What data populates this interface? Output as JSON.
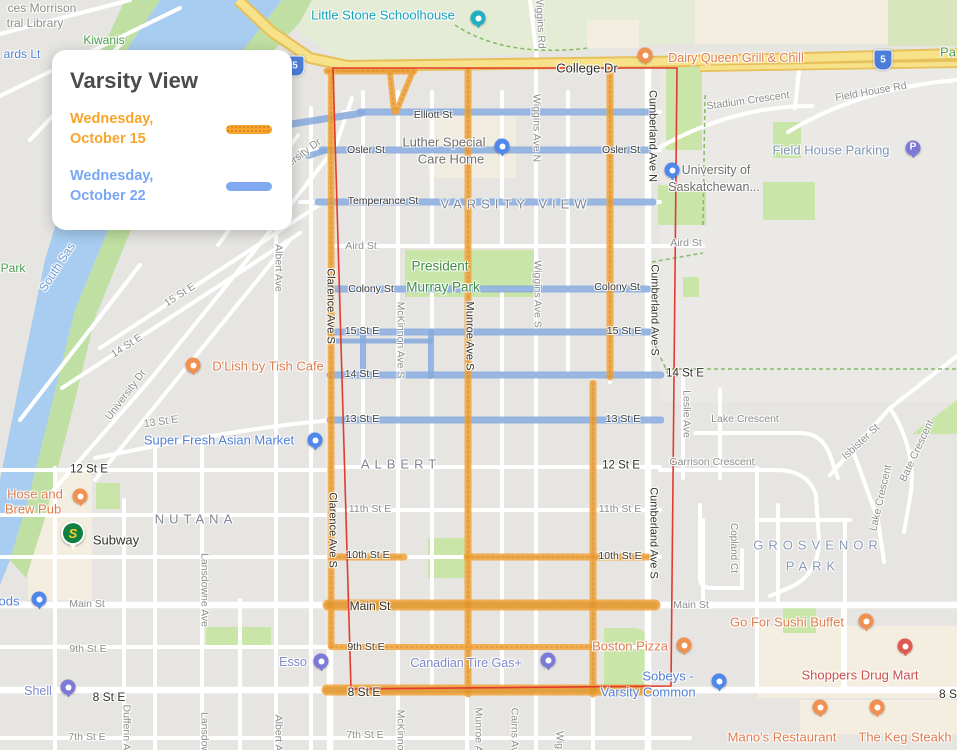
{
  "legend": {
    "title": "Varsity View",
    "entries": [
      {
        "day": "Wednesday,",
        "date": "October 15",
        "color": "#f9a42c",
        "text_color": "#f9a42c"
      },
      {
        "day": "Wednesday,",
        "date": "October 22",
        "color": "#80a9f0",
        "text_color": "#79a7f2"
      }
    ]
  },
  "map": {
    "neighborhood": "Varsity View",
    "boundary": {
      "color": "#e23a2e",
      "points": "333,68 677,68 671,686 351,689"
    },
    "routes": {
      "oct15": {
        "label": "Wednesday, October 15",
        "color": "#f1a33b",
        "texture": "#cf861b",
        "segments": [
          [
            331,
            72,
            331,
            645,
            7
          ],
          [
            468,
            71,
            468,
            694,
            7
          ],
          [
            610,
            71,
            610,
            377,
            7
          ],
          [
            593,
            383,
            593,
            694,
            7
          ],
          [
            327,
            71,
            414,
            71,
            7
          ],
          [
            390,
            73,
            394,
            111,
            6
          ],
          [
            413,
            71,
            396,
            112,
            6
          ],
          [
            334,
            557,
            404,
            557,
            7
          ],
          [
            467,
            557,
            648,
            557,
            7
          ],
          [
            328,
            605,
            655,
            605,
            11
          ],
          [
            331,
            647,
            599,
            647,
            6
          ],
          [
            327,
            690,
            647,
            690,
            11
          ]
        ]
      },
      "oct22": {
        "label": "Wednesday, October 22",
        "color": "#86aadd",
        "segments": [
          [
            273,
            127,
            362,
            113,
            7
          ],
          [
            360,
            112,
            650,
            112,
            7
          ],
          [
            308,
            156,
            324,
            151,
            6
          ],
          [
            322,
            150,
            648,
            150,
            7
          ],
          [
            318,
            202,
            653,
            202,
            7
          ],
          [
            330,
            289,
            648,
            289,
            7
          ],
          [
            330,
            332,
            651,
            332,
            7
          ],
          [
            333,
            341,
            431,
            341,
            5
          ],
          [
            330,
            375,
            661,
            375,
            7
          ],
          [
            330,
            420,
            661,
            420,
            7
          ],
          [
            363,
            332,
            363,
            376,
            6
          ],
          [
            431,
            332,
            431,
            376,
            6
          ]
        ]
      }
    },
    "highway_shields": [
      {
        "n": "5",
        "x": 295,
        "y": 66
      },
      {
        "n": "5",
        "x": 883,
        "y": 60
      }
    ],
    "labels": [
      {
        "t": "ces Morrison",
        "x": 42,
        "y": 8,
        "c": "g",
        "fs": 12
      },
      {
        "t": "tral Library",
        "x": 35,
        "y": 23,
        "c": "g",
        "fs": 12
      },
      {
        "t": "ards Lt",
        "x": 22,
        "y": 54,
        "c": "bl",
        "fs": 12
      },
      {
        "t": "Kiwanis",
        "x": 104,
        "y": 40,
        "c": "grn"
      },
      {
        "t": "Little Stone Schoolhouse",
        "x": 383,
        "y": 15,
        "c": "teal"
      },
      {
        "t": "Wiggins Rd",
        "x": 540,
        "y": 22,
        "r": 87,
        "c": "gv"
      },
      {
        "t": "College Dr",
        "x": 587,
        "y": 68,
        "c": "db",
        "fs": 13
      },
      {
        "t": "Dairy Queen Grill & Chill",
        "x": 736,
        "y": 58,
        "c": "o"
      },
      {
        "t": "Pa",
        "x": 948,
        "y": 52,
        "c": "grn",
        "fs": 13
      },
      {
        "t": "Stadium Crescent",
        "x": 748,
        "y": 101,
        "r": -8,
        "c": "g"
      },
      {
        "t": "Field House Rd",
        "x": 871,
        "y": 92,
        "r": -10,
        "c": "g"
      },
      {
        "t": "Field House Parking",
        "x": 831,
        "y": 150,
        "c": "fhp"
      },
      {
        "t": "University of",
        "x": 716,
        "y": 170,
        "c": "u"
      },
      {
        "t": "Saskatchewan...",
        "x": 714,
        "y": 187,
        "c": "u"
      },
      {
        "t": "Cumberland Ave N",
        "x": 652,
        "y": 136,
        "r": 90,
        "c": "dv"
      },
      {
        "t": "Elliott St",
        "x": 433,
        "y": 115,
        "c": "d"
      },
      {
        "t": "Osler St",
        "x": 366,
        "y": 150,
        "c": "d"
      },
      {
        "t": "Osler St",
        "x": 621,
        "y": 150,
        "c": "d"
      },
      {
        "t": "Luther Special",
        "x": 444,
        "y": 142,
        "c": "u",
        "fs": 13
      },
      {
        "t": "Care Home",
        "x": 451,
        "y": 159,
        "c": "u",
        "fs": 13
      },
      {
        "t": "Temperance St",
        "x": 383,
        "y": 201,
        "c": "d"
      },
      {
        "t": "VARSITY VIEW",
        "x": 516,
        "y": 204,
        "c": "hood"
      },
      {
        "t": "17 St E",
        "x": 261,
        "y": 186,
        "r": -52,
        "c": "g"
      },
      {
        "t": "University Dr",
        "x": 296,
        "y": 159,
        "r": -37,
        "c": "g"
      },
      {
        "t": "Aird St",
        "x": 361,
        "y": 246,
        "c": "g"
      },
      {
        "t": "Aird St",
        "x": 686,
        "y": 243,
        "c": "g"
      },
      {
        "t": "Albert Ave",
        "x": 278,
        "y": 268,
        "r": 90,
        "c": "gv"
      },
      {
        "t": "South Sas",
        "x": 57,
        "y": 267,
        "r": -57,
        "c": "wat"
      },
      {
        "t": "Park",
        "x": 13,
        "y": 268,
        "c": "grn"
      },
      {
        "t": "President",
        "x": 440,
        "y": 266,
        "c": "pk"
      },
      {
        "t": "Murray Park",
        "x": 443,
        "y": 287,
        "c": "pk"
      },
      {
        "t": "Colony St",
        "x": 371,
        "y": 289,
        "c": "d"
      },
      {
        "t": "Colony St",
        "x": 617,
        "y": 287,
        "c": "d"
      },
      {
        "t": "Clarence Ave S",
        "x": 330,
        "y": 306,
        "r": 90,
        "c": "dv"
      },
      {
        "t": "Clarence Ave S",
        "x": 332,
        "y": 530,
        "r": 90,
        "c": "dv"
      },
      {
        "t": "McKinnon Ave S",
        "x": 400,
        "y": 340,
        "r": 90,
        "c": "gv"
      },
      {
        "t": "Munroe Ave S",
        "x": 469,
        "y": 336,
        "r": 90,
        "c": "dv"
      },
      {
        "t": "Wiggins Ave N",
        "x": 536,
        "y": 128,
        "r": 90,
        "c": "gv"
      },
      {
        "t": "Wiggins Ave S",
        "x": 537,
        "y": 294,
        "r": 90,
        "c": "gv"
      },
      {
        "t": "Cumberland Ave S",
        "x": 654,
        "y": 310,
        "r": 90,
        "c": "dv"
      },
      {
        "t": "Cumberland Ave S",
        "x": 653,
        "y": 533,
        "r": 90,
        "c": "dv"
      },
      {
        "t": "15 St E",
        "x": 362,
        "y": 331,
        "c": "d"
      },
      {
        "t": "15 St E",
        "x": 624,
        "y": 331,
        "c": "d"
      },
      {
        "t": "15 St E",
        "x": 180,
        "y": 295,
        "r": -33,
        "c": "g"
      },
      {
        "t": "14 St E",
        "x": 362,
        "y": 374,
        "c": "d"
      },
      {
        "t": "14 St E",
        "x": 685,
        "y": 374,
        "c": "db",
        "fs": 11.5
      },
      {
        "t": "14 St E",
        "x": 127,
        "y": 346,
        "r": -33,
        "c": "g"
      },
      {
        "t": "University Dr",
        "x": 126,
        "y": 395,
        "r": -53,
        "c": "g"
      },
      {
        "t": "13 St E",
        "x": 362,
        "y": 419,
        "c": "d"
      },
      {
        "t": "13 St E",
        "x": 623,
        "y": 419,
        "c": "d"
      },
      {
        "t": "13 St E",
        "x": 161,
        "y": 422,
        "r": -8,
        "c": "g"
      },
      {
        "t": "D'Lish by Tish Cafe",
        "x": 268,
        "y": 366,
        "c": "o",
        "fs": 13
      },
      {
        "t": "Super Fresh Asian Market",
        "x": 219,
        "y": 440,
        "c": "bl",
        "fs": 13
      },
      {
        "t": "12 St E",
        "x": 89,
        "y": 470,
        "c": "db",
        "fs": 11.5
      },
      {
        "t": "12 St E",
        "x": 621,
        "y": 466,
        "c": "db",
        "fs": 11.5
      },
      {
        "t": "ALBERT",
        "x": 401,
        "y": 464,
        "c": "hood"
      },
      {
        "t": "Lake Crescent",
        "x": 745,
        "y": 419,
        "c": "g"
      },
      {
        "t": "Garrison Crescent",
        "x": 712,
        "y": 462,
        "c": "g"
      },
      {
        "t": "Leslie Ave",
        "x": 686,
        "y": 414,
        "r": 90,
        "c": "gv"
      },
      {
        "t": "Isbister St",
        "x": 861,
        "y": 442,
        "r": -43,
        "c": "g"
      },
      {
        "t": "Bate Crescent",
        "x": 917,
        "y": 451,
        "r": -65,
        "c": "g"
      },
      {
        "t": "Lake Crescent",
        "x": 881,
        "y": 498,
        "r": -77,
        "c": "g"
      },
      {
        "t": "11th St E",
        "x": 370,
        "y": 509,
        "c": "g"
      },
      {
        "t": "11th St E",
        "x": 620,
        "y": 509,
        "c": "g"
      },
      {
        "t": "10th St E",
        "x": 368,
        "y": 555,
        "c": "d"
      },
      {
        "t": "10th St E",
        "x": 620,
        "y": 556,
        "c": "d"
      },
      {
        "t": "NUTANA",
        "x": 196,
        "y": 519,
        "c": "hood"
      },
      {
        "t": "Hose and",
        "x": 35,
        "y": 494,
        "c": "o",
        "fs": 13
      },
      {
        "t": "Brew Pub",
        "x": 33,
        "y": 509,
        "c": "o",
        "fs": 13
      },
      {
        "t": "ods",
        "x": 9,
        "y": 601,
        "c": "bl",
        "fs": 13
      },
      {
        "t": "Subway",
        "x": 116,
        "y": 540,
        "c": "db",
        "fs": 13
      },
      {
        "t": "Lansdowne Ave",
        "x": 204,
        "y": 590,
        "r": 90,
        "c": "gv"
      },
      {
        "t": "GROSVENOR",
        "x": 818,
        "y": 545,
        "c": "hoodb"
      },
      {
        "t": "PARK",
        "x": 813,
        "y": 566,
        "c": "hoodb"
      },
      {
        "t": "Copland Ct",
        "x": 733,
        "y": 548,
        "r": 90,
        "c": "gv",
        "fs": 10
      },
      {
        "t": "Main St",
        "x": 87,
        "y": 604,
        "c": "g"
      },
      {
        "t": "Main St",
        "x": 370,
        "y": 606,
        "c": "db"
      },
      {
        "t": "Main St",
        "x": 691,
        "y": 605,
        "c": "g"
      },
      {
        "t": "9th St E",
        "x": 88,
        "y": 649,
        "c": "g"
      },
      {
        "t": "9th St E",
        "x": 366,
        "y": 647,
        "c": "d"
      },
      {
        "t": "Esso",
        "x": 293,
        "y": 662,
        "c": "gas"
      },
      {
        "t": "Canadian Tire Gas+",
        "x": 466,
        "y": 663,
        "c": "gas"
      },
      {
        "t": "Boston Pizza",
        "x": 630,
        "y": 646,
        "c": "o",
        "fs": 13
      },
      {
        "t": "Go For Sushi Buffet",
        "x": 787,
        "y": 622,
        "c": "o",
        "fs": 13
      },
      {
        "t": "Shoppers Drug Mart",
        "x": 860,
        "y": 675,
        "c": "rd",
        "fs": 13
      },
      {
        "t": "Sobeys -",
        "x": 668,
        "y": 676,
        "c": "bl",
        "fs": 13
      },
      {
        "t": "Varsity Common",
        "x": 648,
        "y": 692,
        "c": "bl",
        "fs": 13
      },
      {
        "t": "Shell",
        "x": 38,
        "y": 691,
        "c": "gas"
      },
      {
        "t": "8 St E",
        "x": 109,
        "y": 697,
        "c": "db"
      },
      {
        "t": "8 St E",
        "x": 364,
        "y": 692,
        "c": "db"
      },
      {
        "t": "8 S",
        "x": 948,
        "y": 694,
        "c": "db"
      },
      {
        "t": "7th St E",
        "x": 87,
        "y": 737,
        "c": "g"
      },
      {
        "t": "7th St E",
        "x": 365,
        "y": 735,
        "c": "g"
      },
      {
        "t": "Dufferin Av",
        "x": 126,
        "y": 730,
        "r": 90,
        "c": "gv"
      },
      {
        "t": "Lansdow",
        "x": 204,
        "y": 733,
        "r": 90,
        "c": "gv"
      },
      {
        "t": "Albert A",
        "x": 278,
        "y": 733,
        "r": 90,
        "c": "gv"
      },
      {
        "t": "McKinno",
        "x": 400,
        "y": 730,
        "r": 90,
        "c": "gv"
      },
      {
        "t": "Munroe A",
        "x": 478,
        "y": 730,
        "r": 90,
        "c": "gv"
      },
      {
        "t": "Cairns Av",
        "x": 514,
        "y": 730,
        "r": 90,
        "c": "gv"
      },
      {
        "t": "Wig",
        "x": 559,
        "y": 740,
        "r": 90,
        "c": "gv"
      },
      {
        "t": "Mano's Restaurant",
        "x": 782,
        "y": 737,
        "c": "o",
        "fs": 13
      },
      {
        "t": "The Keg Steakh",
        "x": 905,
        "y": 737,
        "c": "o",
        "fs": 13
      }
    ],
    "pois": [
      {
        "name": "little-stone-schoolhouse",
        "x": 478,
        "y": 18,
        "color": "#1fb0c3",
        "glyph": "dot"
      },
      {
        "name": "dairy-queen",
        "x": 645,
        "y": 55,
        "color": "#f09151",
        "glyph": "dot"
      },
      {
        "name": "field-house-parking",
        "x": 913,
        "y": 148,
        "color": "#7d79d8",
        "glyph": "P"
      },
      {
        "name": "university-of-saskatchewan",
        "x": 672,
        "y": 170,
        "color": "#4f87ec",
        "glyph": "dot"
      },
      {
        "name": "luther-special-care-home",
        "x": 502,
        "y": 146,
        "color": "#4f87ec",
        "glyph": "dot"
      },
      {
        "name": "dlish-by-tish-cafe",
        "x": 193,
        "y": 365,
        "color": "#f09151",
        "glyph": "dot"
      },
      {
        "name": "super-fresh-asian-market",
        "x": 315,
        "y": 440,
        "color": "#4f87ec",
        "glyph": "dot"
      },
      {
        "name": "hose-and-brew-pub",
        "x": 80,
        "y": 496,
        "color": "#f09151",
        "glyph": "dot"
      },
      {
        "name": "subway",
        "x": 73,
        "y": 536,
        "color": "#0f8040",
        "glyph": "S"
      },
      {
        "name": "store-ods",
        "x": 39,
        "y": 599,
        "color": "#4f87ec",
        "glyph": "dot"
      },
      {
        "name": "esso",
        "x": 321,
        "y": 661,
        "color": "#7d79d8",
        "glyph": "dot"
      },
      {
        "name": "canadian-tire-gas",
        "x": 548,
        "y": 660,
        "color": "#7d79d8",
        "glyph": "dot"
      },
      {
        "name": "shell",
        "x": 68,
        "y": 687,
        "color": "#7d79d8",
        "glyph": "dot"
      },
      {
        "name": "boston-pizza",
        "x": 684,
        "y": 645,
        "color": "#f09151",
        "glyph": "dot"
      },
      {
        "name": "sobeys-varsity-common",
        "x": 719,
        "y": 681,
        "color": "#4f87ec",
        "glyph": "dot"
      },
      {
        "name": "go-for-sushi-buffet",
        "x": 866,
        "y": 621,
        "color": "#f09151",
        "glyph": "dot"
      },
      {
        "name": "shoppers-drug-mart",
        "x": 905,
        "y": 646,
        "color": "#df5a50",
        "glyph": "dot"
      },
      {
        "name": "manos-restaurant",
        "x": 820,
        "y": 707,
        "color": "#f09151",
        "glyph": "dot"
      },
      {
        "name": "the-keg-steakhouse",
        "x": 877,
        "y": 707,
        "color": "#f09151",
        "glyph": "dot"
      }
    ]
  }
}
